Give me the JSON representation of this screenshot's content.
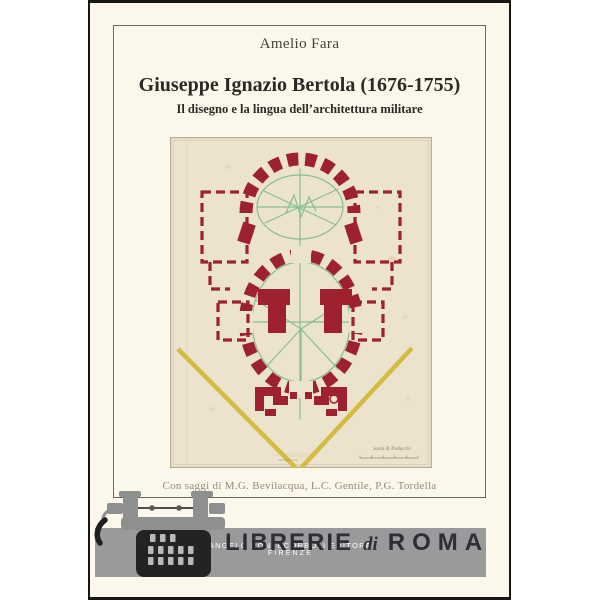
{
  "cover": {
    "author": "Amelio Fara",
    "title": "Giuseppe Ignazio Bertola (1676-1755)",
    "subtitle": "Il disegno e la lingua dell’architettura militare",
    "essays_credit": "Con saggi di M.G. Bevilacqua, L.C. Gentile, P.G. Tordella"
  },
  "publisher": {
    "name": "ANGELO PONTECORBOLI EDITORE",
    "city": "FIRENZE"
  },
  "watermark": {
    "librerie": "LIBRERIE",
    "di": "di",
    "roma": "ROMA"
  },
  "drawing": {
    "caption": "Scala di Trabucchi",
    "description": "Ink and watercolor plan of an oval-plan church: two elliptical halls ringed by red masonry piers, dashed rectangular side wings, green geometric construction lines and yellow V-shaped glacis lines"
  },
  "colors": {
    "cover-bg": "#FBF7EA",
    "cover-border": "#161616",
    "frame-line": "#6B675C",
    "text-dark": "#2B2A26",
    "author-text": "#45423A",
    "essays-text": "#938B7B",
    "paper": "#EBE3CD",
    "paper-edge": "#B9AE92",
    "wall-red": "#9E2130",
    "line-green": "#86BD92",
    "glacis-yellow": "#D4BB42",
    "band-gray": "#9A9A9C",
    "watermark-text": "#2E2E33",
    "typewriter-gray": "#8E8F8F",
    "typewriter-black": "#232325",
    "publisher-white": "#FFFFFF"
  }
}
